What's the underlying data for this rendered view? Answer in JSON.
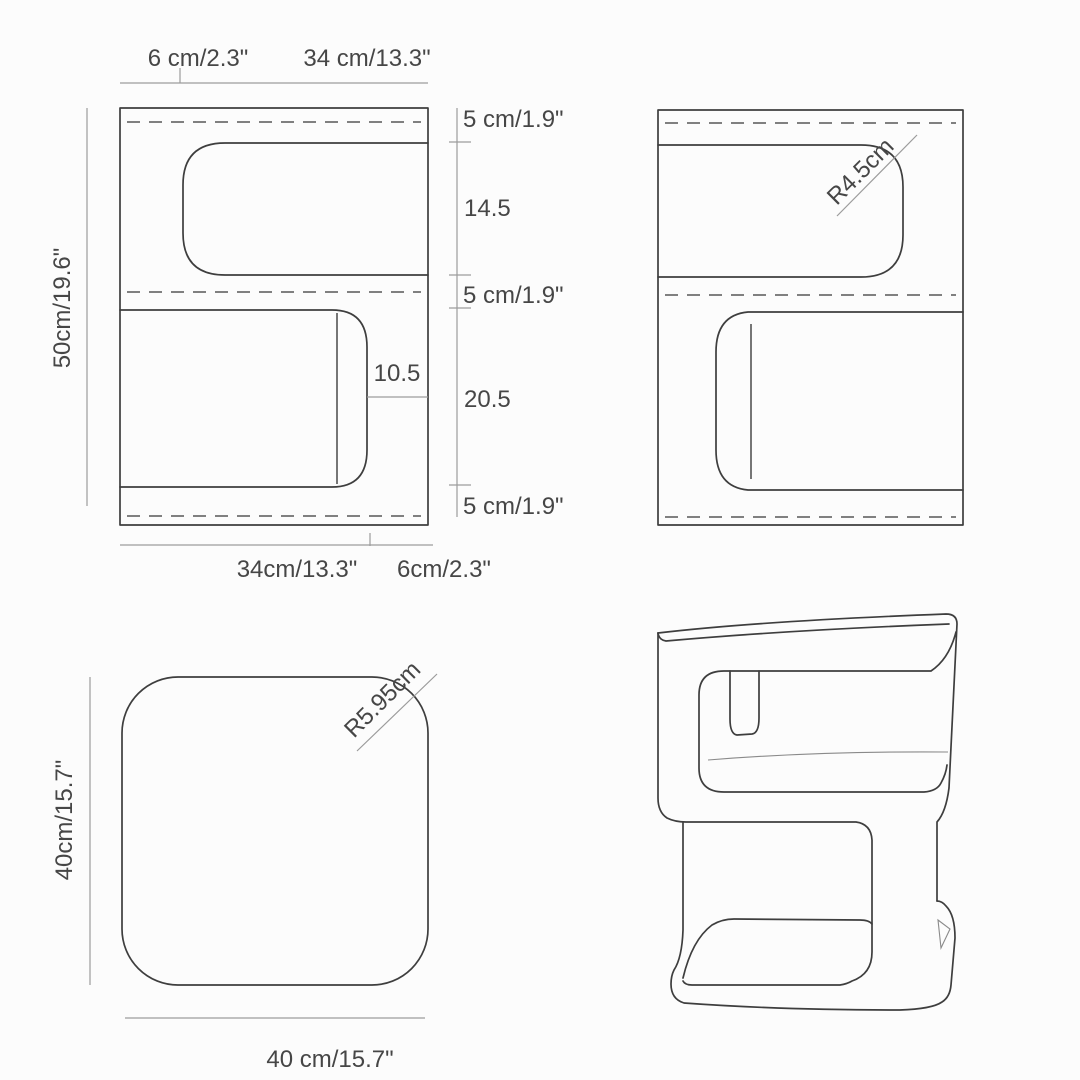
{
  "colors": {
    "background": "#fcfcfc",
    "outline": "#3e3e3e",
    "dimension_line": "#9b9b9b",
    "dashed_line": "#6f6f6f",
    "text": "#464646"
  },
  "front_view": {
    "top_dim_left": "6 cm/2.3\"",
    "top_dim_right": "34 cm/13.3\"",
    "left_dim": "50cm/19.6\"",
    "right_dims": [
      "5 cm/1.9\"",
      "14.5",
      "5 cm/1.9\"",
      "20.5",
      "5 cm/1.9\""
    ],
    "inner_dim": "10.5",
    "bottom_dim_left": "34cm/13.3\"",
    "bottom_dim_right": "6cm/2.3\""
  },
  "side_view": {
    "corner_radius": "R4.5cm"
  },
  "top_view": {
    "corner_radius": "R5.95cm",
    "left_dim": "40cm/15.7\"",
    "bottom_dim": "40 cm/15.7\""
  }
}
